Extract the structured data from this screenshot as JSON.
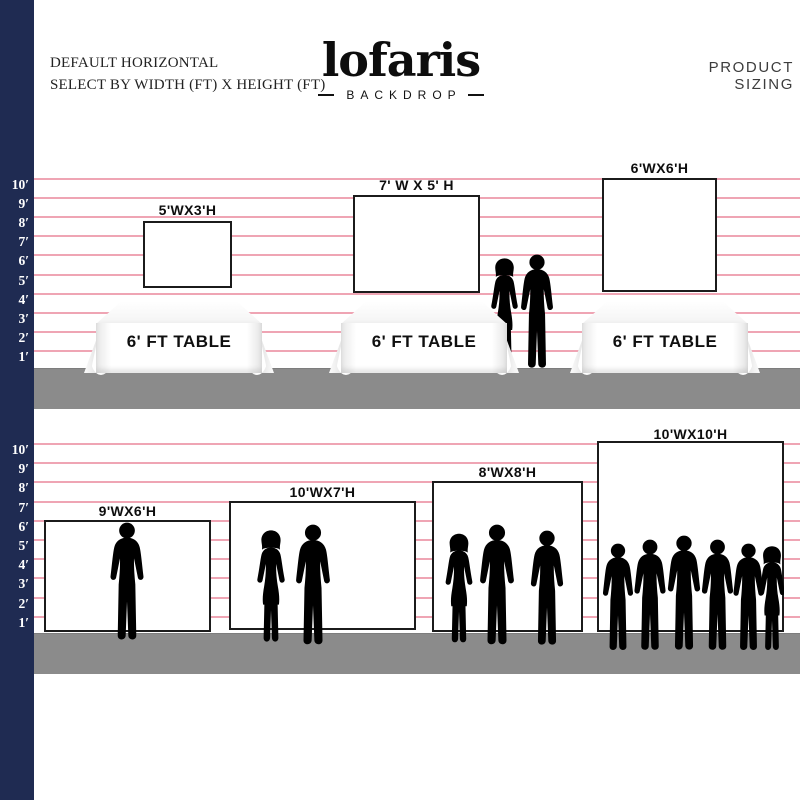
{
  "header": {
    "subtitle_line1": "DEFAULT HORIZONTAL",
    "subtitle_line2": "SELECT BY WIDTH (FT) X HEIGHT (FT)",
    "logo_text": "lofaris",
    "logo_tagline": "BACKDROP",
    "product_sizing_label": "PRODUCT SIZING"
  },
  "ruler": {
    "unit_labels": [
      "10′",
      "9′",
      "8′",
      "7′",
      "6′",
      "5′",
      "4′",
      "3′",
      "2′",
      "1′"
    ]
  },
  "top_section": {
    "backdrops": [
      {
        "size_label": "5'WX3'H"
      },
      {
        "size_label": "7' W X 5' H"
      },
      {
        "size_label": "6'WX6'H"
      }
    ],
    "tables": [
      {
        "label": "6' FT TABLE"
      },
      {
        "label": "6' FT TABLE"
      },
      {
        "label": "6' FT TABLE"
      }
    ]
  },
  "bottom_section": {
    "backdrops": [
      {
        "size_label": "9'WX6'H"
      },
      {
        "size_label": "10'WX7'H"
      },
      {
        "size_label": "8'WX8'H"
      },
      {
        "size_label": "10'WX10'H"
      }
    ]
  },
  "colors": {
    "navy_bar": "#1f2b52",
    "pink_line": "#efa5b4",
    "floor_gray": "#8b8b8b",
    "silhouette_gray": "#bcbcbc"
  }
}
